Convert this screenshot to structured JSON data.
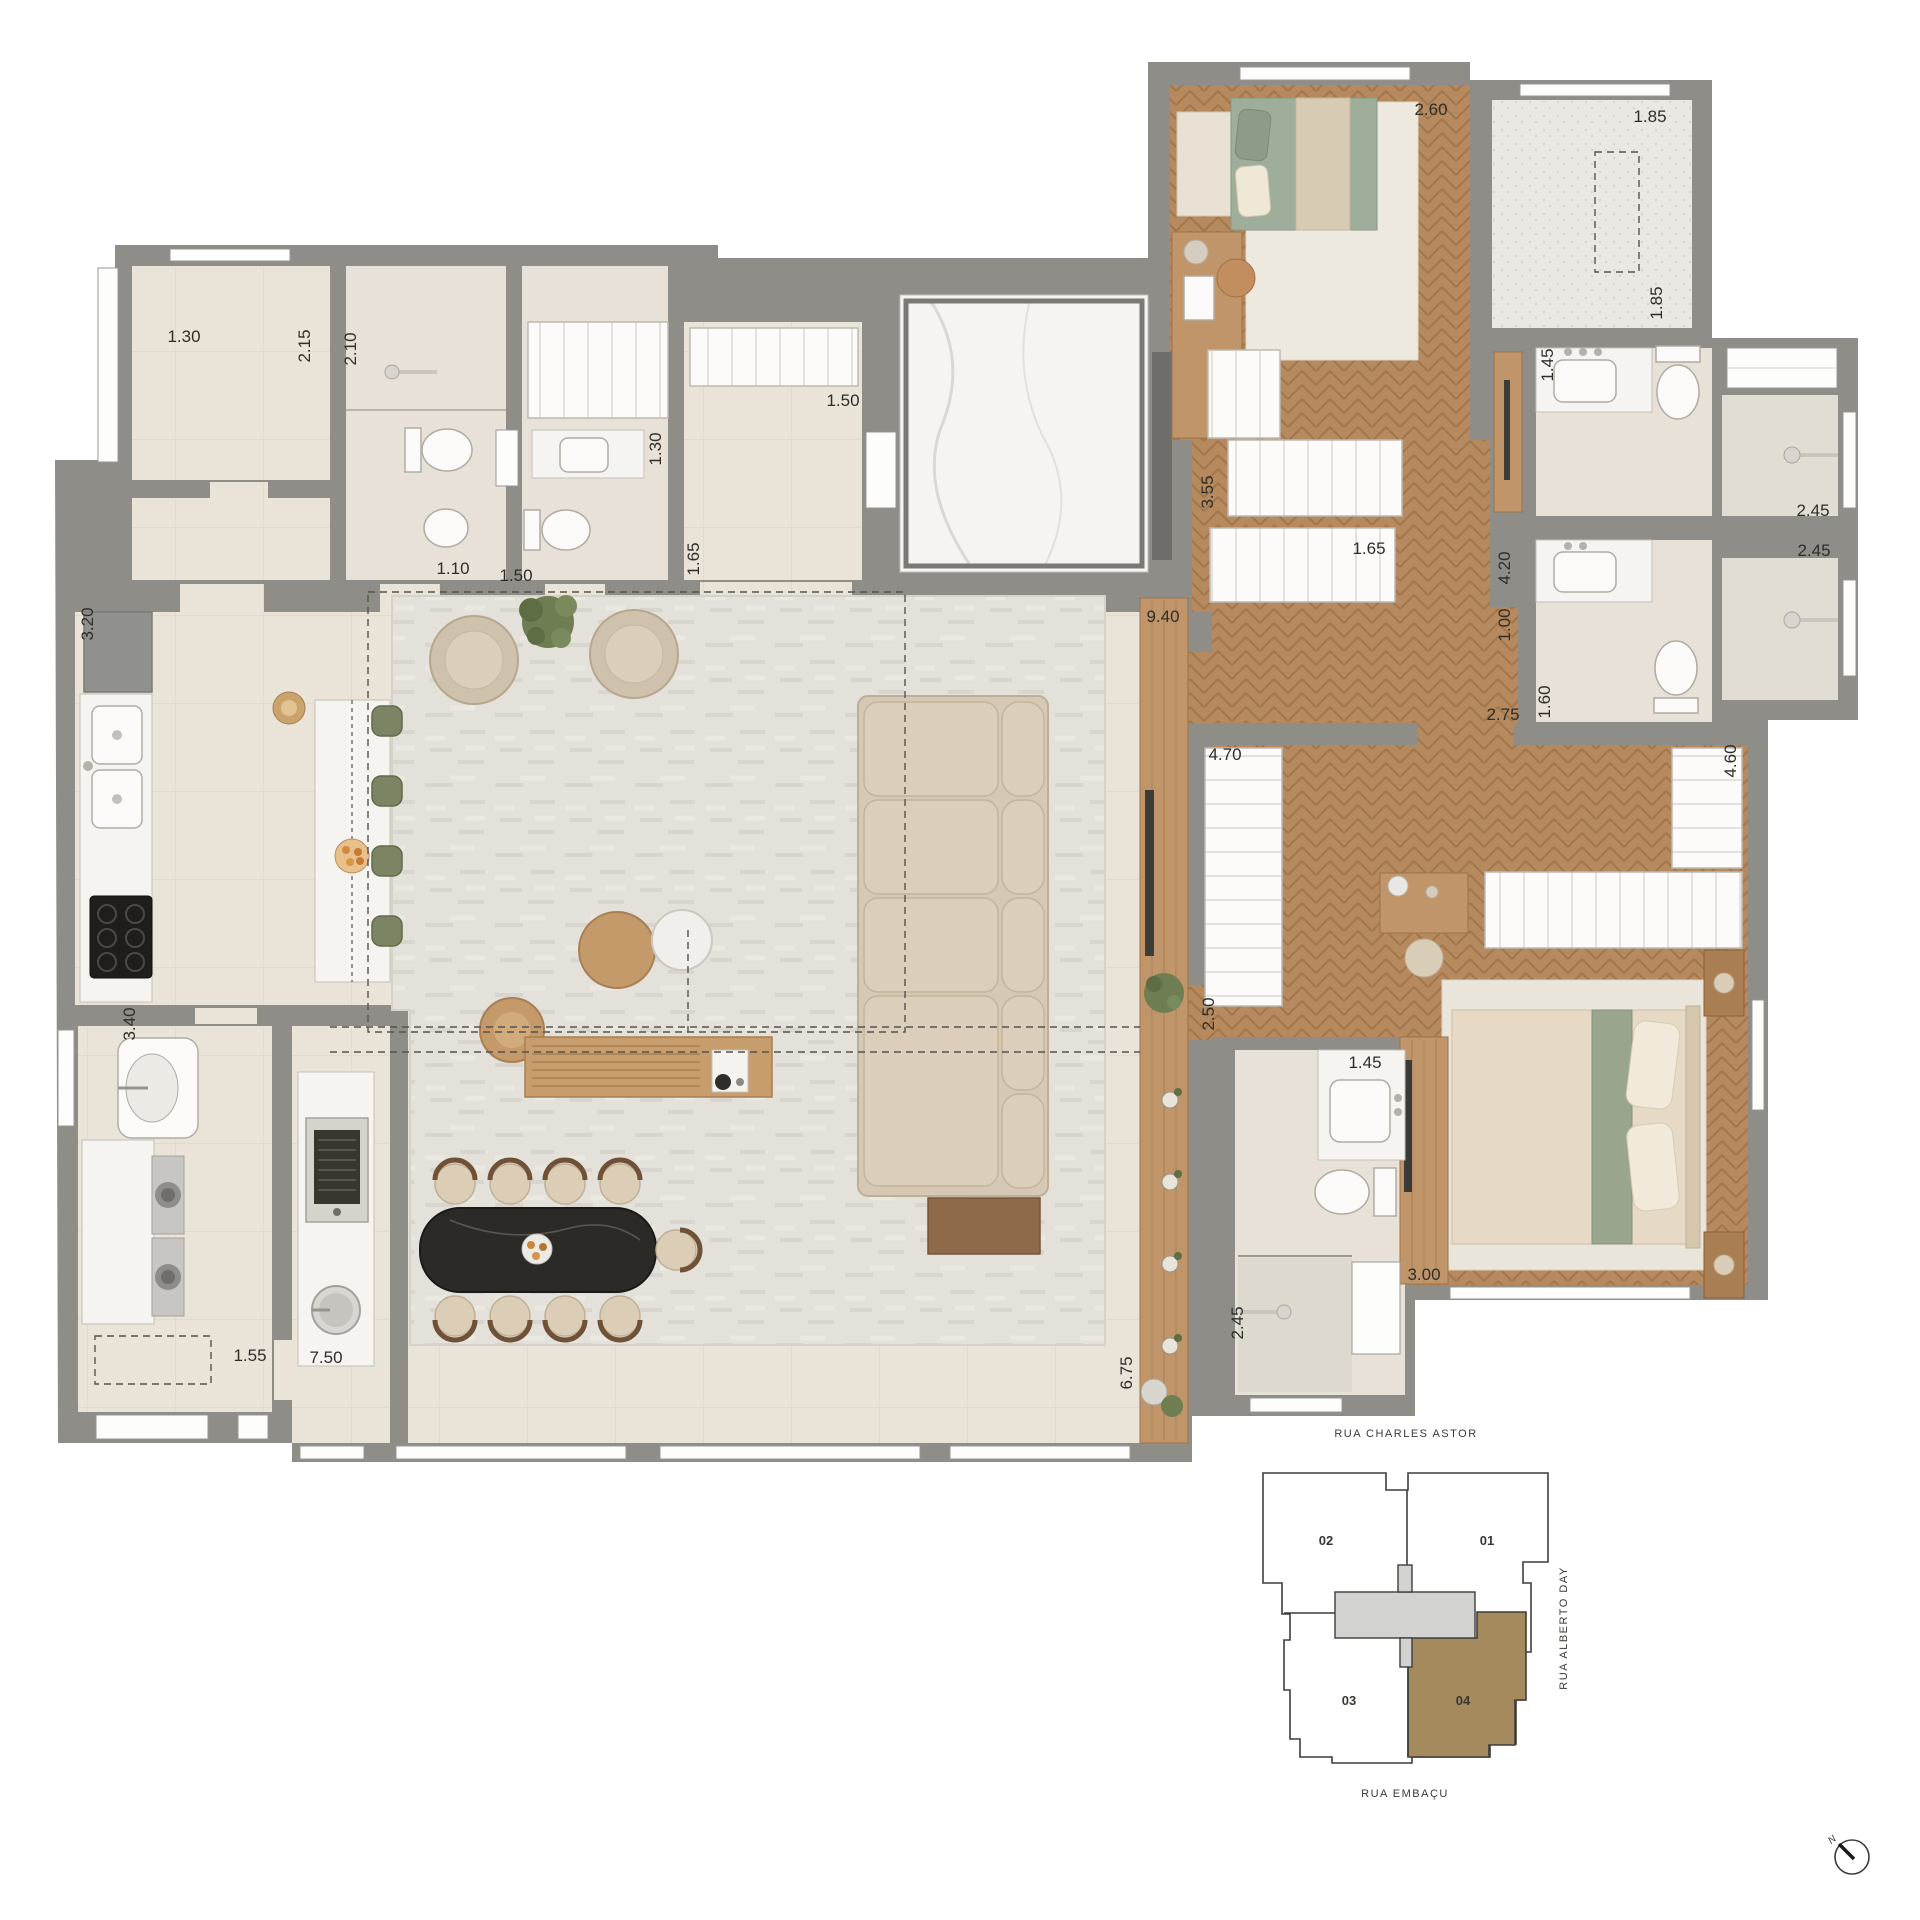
{
  "floorplan": {
    "dims": {
      "d_260": "2.60",
      "d_185a": "1.85",
      "d_185b": "1.85",
      "d_130a": "1.30",
      "d_215": "2.15",
      "d_210": "2.10",
      "d_110": "1.10",
      "d_150a": "1.50",
      "d_130b": "1.30",
      "d_165a": "1.65",
      "d_150b": "1.50",
      "d_355": "3.55",
      "d_165b": "1.65",
      "d_940": "9.40",
      "d_145a": "1.45",
      "d_420": "4.20",
      "d_100": "1.00",
      "d_275": "2.75",
      "d_160": "1.60",
      "d_245a": "2.45",
      "d_245b": "2.45",
      "d_470": "4.70",
      "d_460": "4.60",
      "d_250": "2.50",
      "d_145b": "1.45",
      "d_245c": "2.45",
      "d_300": "3.00",
      "d_675": "6.75",
      "d_320": "3.20",
      "d_340": "3.40",
      "d_155": "1.55",
      "d_750": "7.50"
    }
  },
  "keyplan": {
    "street_top": "RUA CHARLES ASTOR",
    "street_right": "RUA ALBERTO DAY",
    "street_bottom": "RUA EMBAÇU",
    "unit_01": "01",
    "unit_02": "02",
    "unit_03": "03",
    "unit_04": "04",
    "highlighted_unit": "04",
    "highlight_color": "#a58a5e",
    "core_color": "#d2d2d0"
  },
  "compass": {
    "north": "N"
  },
  "colors": {
    "wall": "#8f8d88",
    "wood_floor": "#b68a5e",
    "tile_floor": "#e8e2d7",
    "rug": "#e3e1d9",
    "sofa": "#d5c8b4",
    "accent_green": "#7c8464",
    "dining_table": "#2b2a27",
    "marble": "#f5f4f1"
  }
}
